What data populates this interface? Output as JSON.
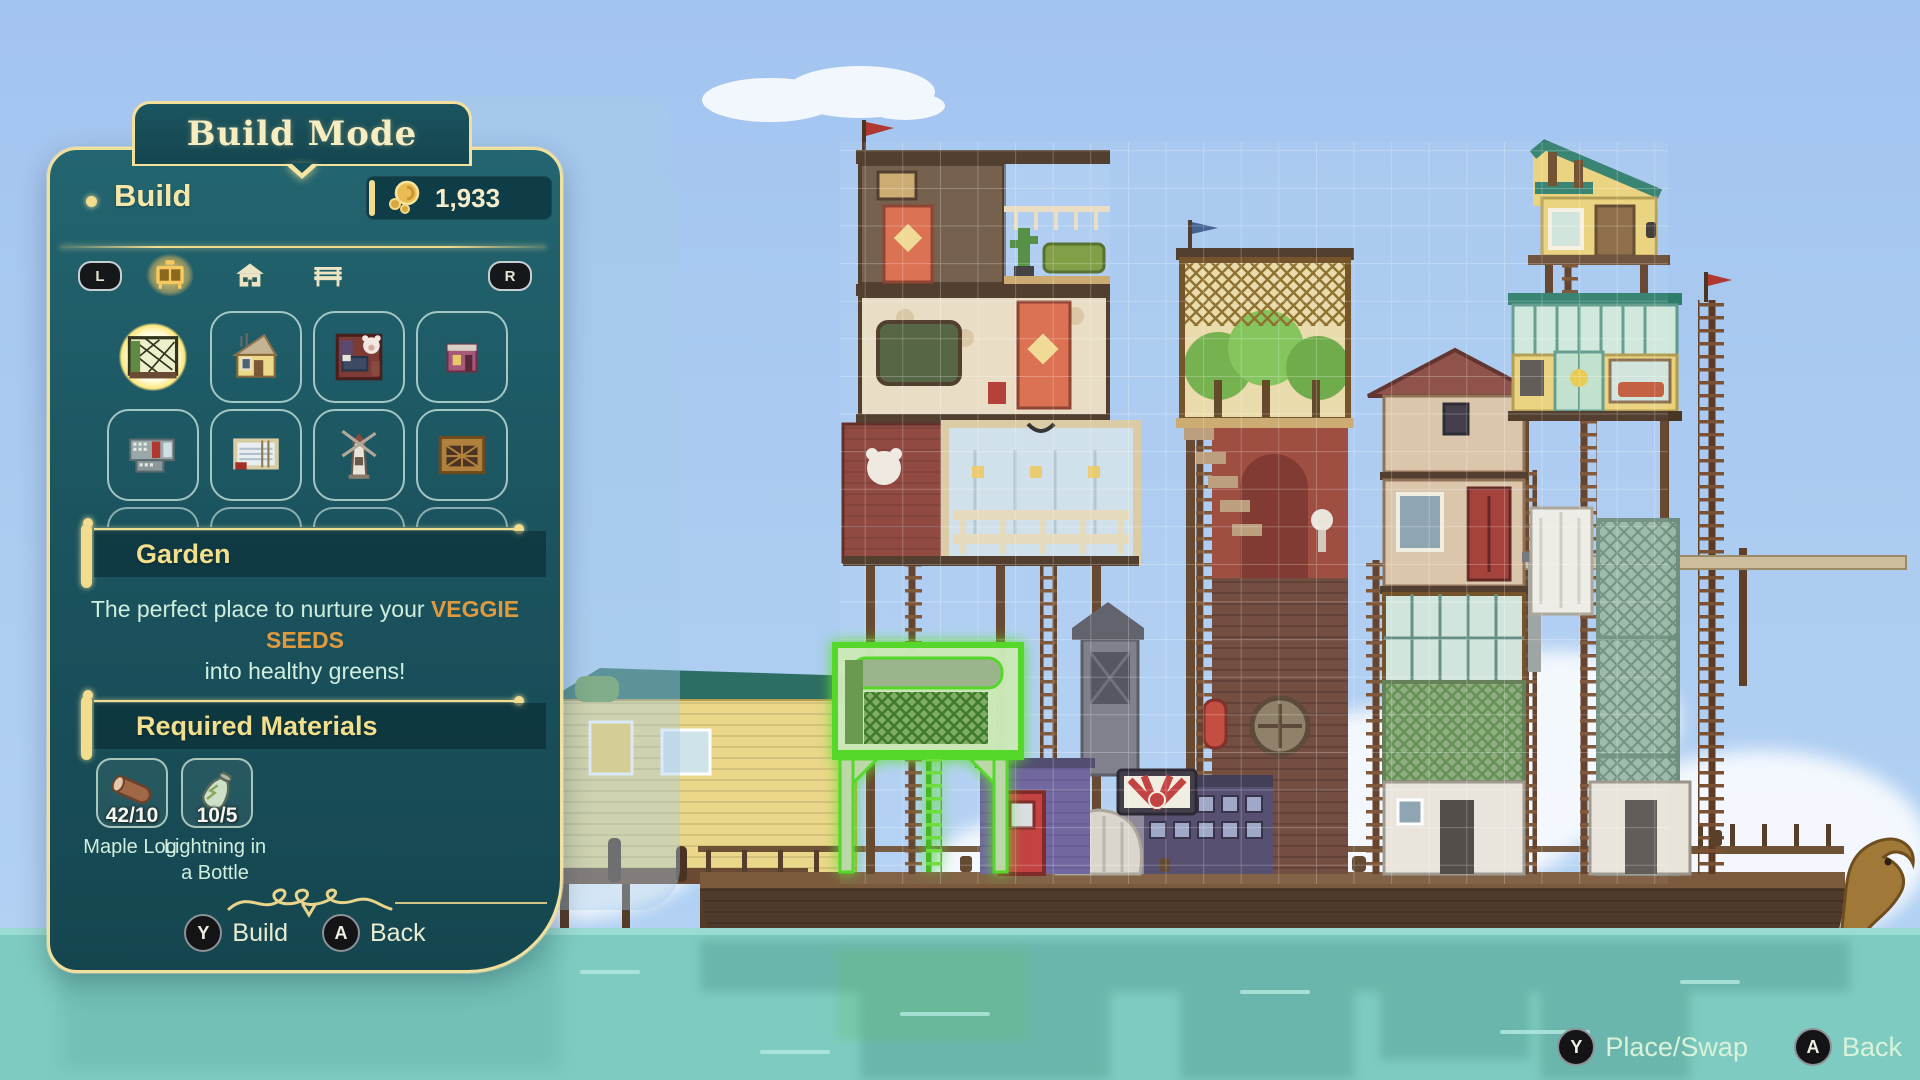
{
  "colors": {
    "panel_teal": "#1b545f",
    "gold": "#f2dc8e",
    "cream": "#f5e7a9",
    "mint": "#cfeedd",
    "orange_highlight": "#e09a3e",
    "sky": "#a7c7f1",
    "water": "#7eccc1",
    "placement_green": "#5ddc2e"
  },
  "hud": {
    "mode_title": "Build Mode",
    "tab_label": "Build",
    "currency": {
      "amount": "1,933",
      "icon": "glim-coin-icon"
    },
    "shoulders": {
      "left": "L",
      "right": "R"
    },
    "categories": [
      {
        "name": "furniture",
        "icon": "stove-icon",
        "active": true
      },
      {
        "name": "buildings",
        "icon": "house-icon",
        "active": false
      },
      {
        "name": "outdoor",
        "icon": "bench-icon",
        "active": false
      }
    ],
    "grid_items": [
      {
        "icon": "thumb-garden",
        "selected": true
      },
      {
        "icon": "thumb-guest-house",
        "selected": false
      },
      {
        "icon": "thumb-bedroom",
        "selected": false
      },
      {
        "icon": "thumb-shop",
        "selected": false
      },
      {
        "icon": "thumb-kitchen",
        "selected": false
      },
      {
        "icon": "thumb-loom",
        "selected": false
      },
      {
        "icon": "thumb-windmill",
        "selected": false
      },
      {
        "icon": "thumb-pen",
        "selected": false
      }
    ],
    "selected_item": {
      "name": "Garden",
      "description_prefix": "The perfect place to nurture your ",
      "description_highlight": "VEGGIE SEEDS",
      "description_line2": "into healthy greens!"
    },
    "materials_title": "Required Materials",
    "materials": [
      {
        "name": "Maple Log",
        "count": "42/10",
        "icon": "log-icon"
      },
      {
        "name": "Lightning in a Bottle",
        "count": "10/5",
        "icon": "bottle-icon"
      }
    ],
    "panel_buttons": [
      {
        "key": "Y",
        "label": "Build"
      },
      {
        "key": "A",
        "label": "Back"
      }
    ],
    "screen_hints": [
      {
        "key": "Y",
        "label": "Place/Swap"
      },
      {
        "key": "A",
        "label": "Back"
      }
    ]
  }
}
